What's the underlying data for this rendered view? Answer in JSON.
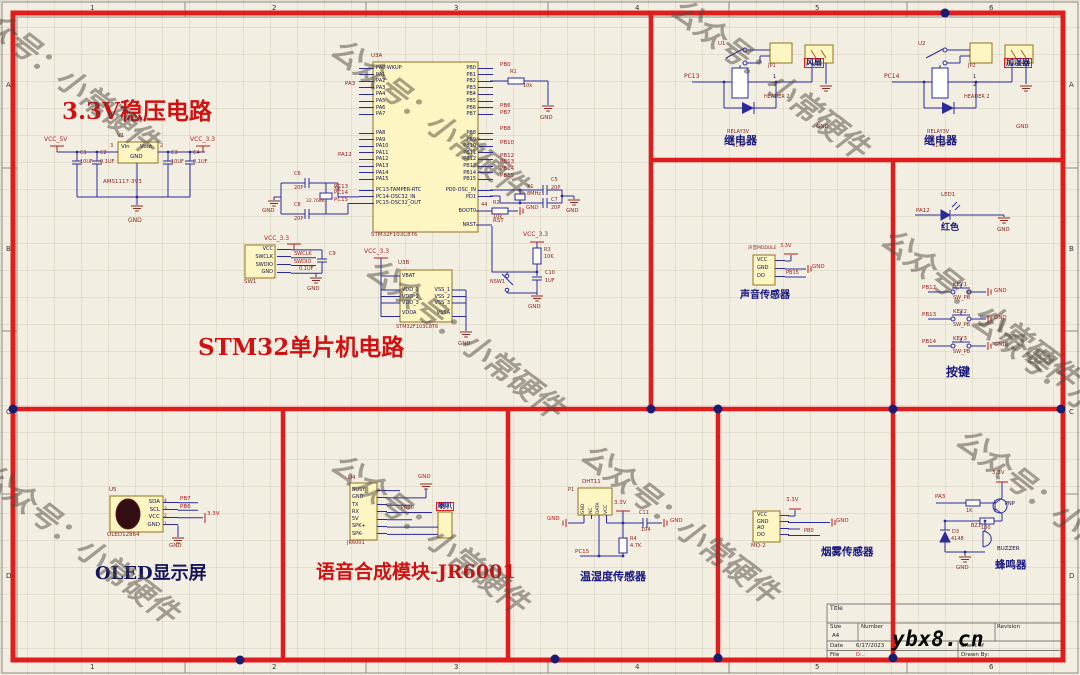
{
  "frame": {
    "cols": [
      "1",
      "2",
      "3",
      "4",
      "5",
      "6"
    ],
    "rows": [
      "A",
      "B",
      "C",
      "D"
    ]
  },
  "watermark": {
    "text": "公众号：小常硬件"
  },
  "overlay": {
    "site": "ybx8.cn"
  },
  "regulator": {
    "title": "3.3V稳压电路",
    "designator": "V1",
    "part": "AMS1117-3V3",
    "pin_vin": "Vin",
    "pin_vout": "Vout",
    "pin_gnd": "GND",
    "net_in": "VCC_5V",
    "net_out": "VCC_3.3",
    "gnd": "GND",
    "pn_a": "3",
    "pn_b": "2",
    "caps": [
      {
        "ref": "C1",
        "val": "10UF"
      },
      {
        "ref": "C2",
        "val": "0.1UF"
      },
      {
        "ref": "C3",
        "val": "10UF"
      },
      {
        "ref": "C4",
        "val": "0.1UF"
      }
    ]
  },
  "mcu": {
    "title": "STM32单片机电路",
    "designator_a": "U3A",
    "designator_b": "U3B",
    "part": "STM32F103C8T6",
    "pins_l1": [
      "PA0-WKUP",
      "PA1",
      "PA2",
      "PA3",
      "PA4",
      "PA5",
      "PA6",
      "PA7"
    ],
    "pins_l2": [
      "PA8",
      "PA9",
      "PA10",
      "PA11",
      "PA12",
      "PA13",
      "PA14",
      "PA15"
    ],
    "pins_l3": [
      "PC13-TAMPER-RTC",
      "PC14-OSC32_IN",
      "PC15-OSC32_OUT"
    ],
    "pins_r1": [
      "PB0",
      "PB1",
      "PB2",
      "PB3",
      "PB4",
      "PB5",
      "PB6",
      "PB7"
    ],
    "pins_r2": [
      "PB8",
      "PB9",
      "PB10",
      "PB11",
      "PB12",
      "PB13",
      "PB14",
      "PB15"
    ],
    "pins_r3": [
      "PD0-OSC_IN",
      "PD1"
    ],
    "pin_boot0": "BOOT0",
    "pin_nrst": "NRST",
    "b_left": [
      "VBAT",
      "VDD_1",
      "VDD_2",
      "VDD_3",
      "VDDA"
    ],
    "b_right": [
      "VSS_1",
      "VSS_2",
      "VSS_3",
      "VSSA"
    ],
    "net_pa3": "PA3",
    "net_pa12": "PA12",
    "net_pc13": "PC13",
    "net_pc14": "PC14",
    "net_pc15": "PC15",
    "net_pb0": "PB0",
    "net_pb6": "PB6",
    "net_pb7": "PB7",
    "net_pb8": "PB8",
    "net_pb10": "PB10",
    "net_pb12": "PB12",
    "net_pb13": "PB13",
    "net_pb14": "PB14",
    "net_pb15": "PB15",
    "net_rst": "RST",
    "pwr_33": "VCC_3.3",
    "gnd": "GND",
    "gnd_flag": "GND",
    "r1": {
      "ref": "R1",
      "val": "10k"
    },
    "r2": {
      "pin": "44",
      "ref": "R2",
      "val": "10k"
    },
    "r3": {
      "ref": "R3",
      "val": "10K"
    },
    "c10": {
      "ref": "C10",
      "val": "1UF"
    },
    "x1": {
      "ref": "X1",
      "val": "8MHz"
    },
    "c5": {
      "ref": "C5",
      "val": "20P"
    },
    "c7": {
      "ref": "C7",
      "val": "20P"
    },
    "x2": {
      "ref": "X2",
      "val": "32.768K"
    },
    "c6": {
      "ref": "C6",
      "val": "20P"
    },
    "c8": {
      "ref": "C8",
      "val": "20P"
    },
    "nsw": "NSW1",
    "debug": {
      "designator": "SW1",
      "pins": [
        "VCC",
        "SWCLK",
        "SWDIO",
        "GND"
      ],
      "net_swclk": "SWCLK",
      "net_swdio": "SWDIO",
      "c9": {
        "ref": "C9",
        "val": "0.1UF"
      }
    }
  },
  "relays": [
    {
      "designator": "U1",
      "part": "RELAY3V",
      "diode": "4148",
      "jp": "JP1",
      "p1": "1",
      "p2": "2",
      "jp_part": "HEADER 2",
      "load": "风扇",
      "net": "PC13",
      "gnd": "GND",
      "caption": "继电器"
    },
    {
      "designator": "U2",
      "part": "RELAY3V",
      "diode": "4148",
      "jp": "JP2",
      "p1": "1",
      "p2": "2",
      "jp_part": "HEADER 2",
      "load": "加湿器",
      "net": "PC14",
      "gnd": "GND",
      "caption": "继电器"
    }
  ],
  "sound": {
    "designator": "声音MODULE",
    "pins": [
      "VCC",
      "GND",
      "DO"
    ],
    "net": "PB15",
    "power": "3.3V",
    "gnd": "GND",
    "caption": "声音传感器"
  },
  "led": {
    "ref": "LED1",
    "net": "PA12",
    "color_label": "红色",
    "gnd": "GND"
  },
  "keys": {
    "caption": "按键",
    "items": [
      {
        "ref": "KEY1",
        "part": "SW_PB",
        "net": "PB12",
        "gnd": "GND"
      },
      {
        "ref": "KEY2",
        "part": "SW_PB",
        "net": "PB13",
        "gnd": "GND"
      },
      {
        "ref": "KEY3",
        "part": "SW_PB",
        "net": "PB14",
        "gnd": "GND"
      }
    ]
  },
  "oled": {
    "designator": "U5",
    "part": "OLED12864",
    "caption": "OLED显示屏",
    "pins": [
      {
        "name": "SDA",
        "num": "4",
        "net": "PB7"
      },
      {
        "name": "SCL",
        "num": "3",
        "net": "PB6"
      },
      {
        "name": "VCC",
        "num": "2",
        "net": "3.3V"
      },
      {
        "name": "GND",
        "num": "1",
        "net": "GND"
      }
    ]
  },
  "voice": {
    "designator": "U4",
    "part": "JR6001",
    "caption": "语音合成模块-JR6001",
    "pins": [
      "BUSY",
      "GND",
      "TX",
      "RX",
      "5V",
      "SPK+",
      "SPK-"
    ],
    "net_rx": "PB10",
    "gnd": "GND",
    "speaker": "喇叭"
  },
  "dht": {
    "designator": "P1",
    "part": "DHT11",
    "caption": "温湿度传感器",
    "pins": [
      "GND",
      "NC",
      "DATA",
      "VCC"
    ],
    "net": "PC15",
    "power": "3.3V",
    "gnd": "GND",
    "gnd2": "GND",
    "r4": {
      "ref": "R4",
      "val": "4.7K"
    },
    "c11": {
      "ref": "C11",
      "val": "104"
    }
  },
  "mq2": {
    "designator": "MQ-2",
    "caption": "烟雾传感器",
    "pins": [
      "VCC",
      "GND",
      "AO",
      "DO"
    ],
    "power": "3.3V",
    "net": "PB0",
    "gnd": "GND"
  },
  "buzzer": {
    "caption": "蜂鸣器",
    "net": "PA3",
    "r1": "1K",
    "r2": "100",
    "transistor": "PNP",
    "power": "3.3V",
    "d_ref": "D3",
    "d_val": "4148",
    "bz_ref": "BZ1",
    "bz_val": "BUZZER",
    "gnd": "GND"
  },
  "titleblock": {
    "title_label": "Title",
    "size_label": "Size",
    "size": "A4",
    "number_label": "Number",
    "revision_label": "Revision",
    "date_label": "Date",
    "date": "6/17/2023",
    "sheet_label": "Sheet  of",
    "file_label": "File",
    "file": "D:..",
    "drawn_label": "Drawn By:"
  }
}
